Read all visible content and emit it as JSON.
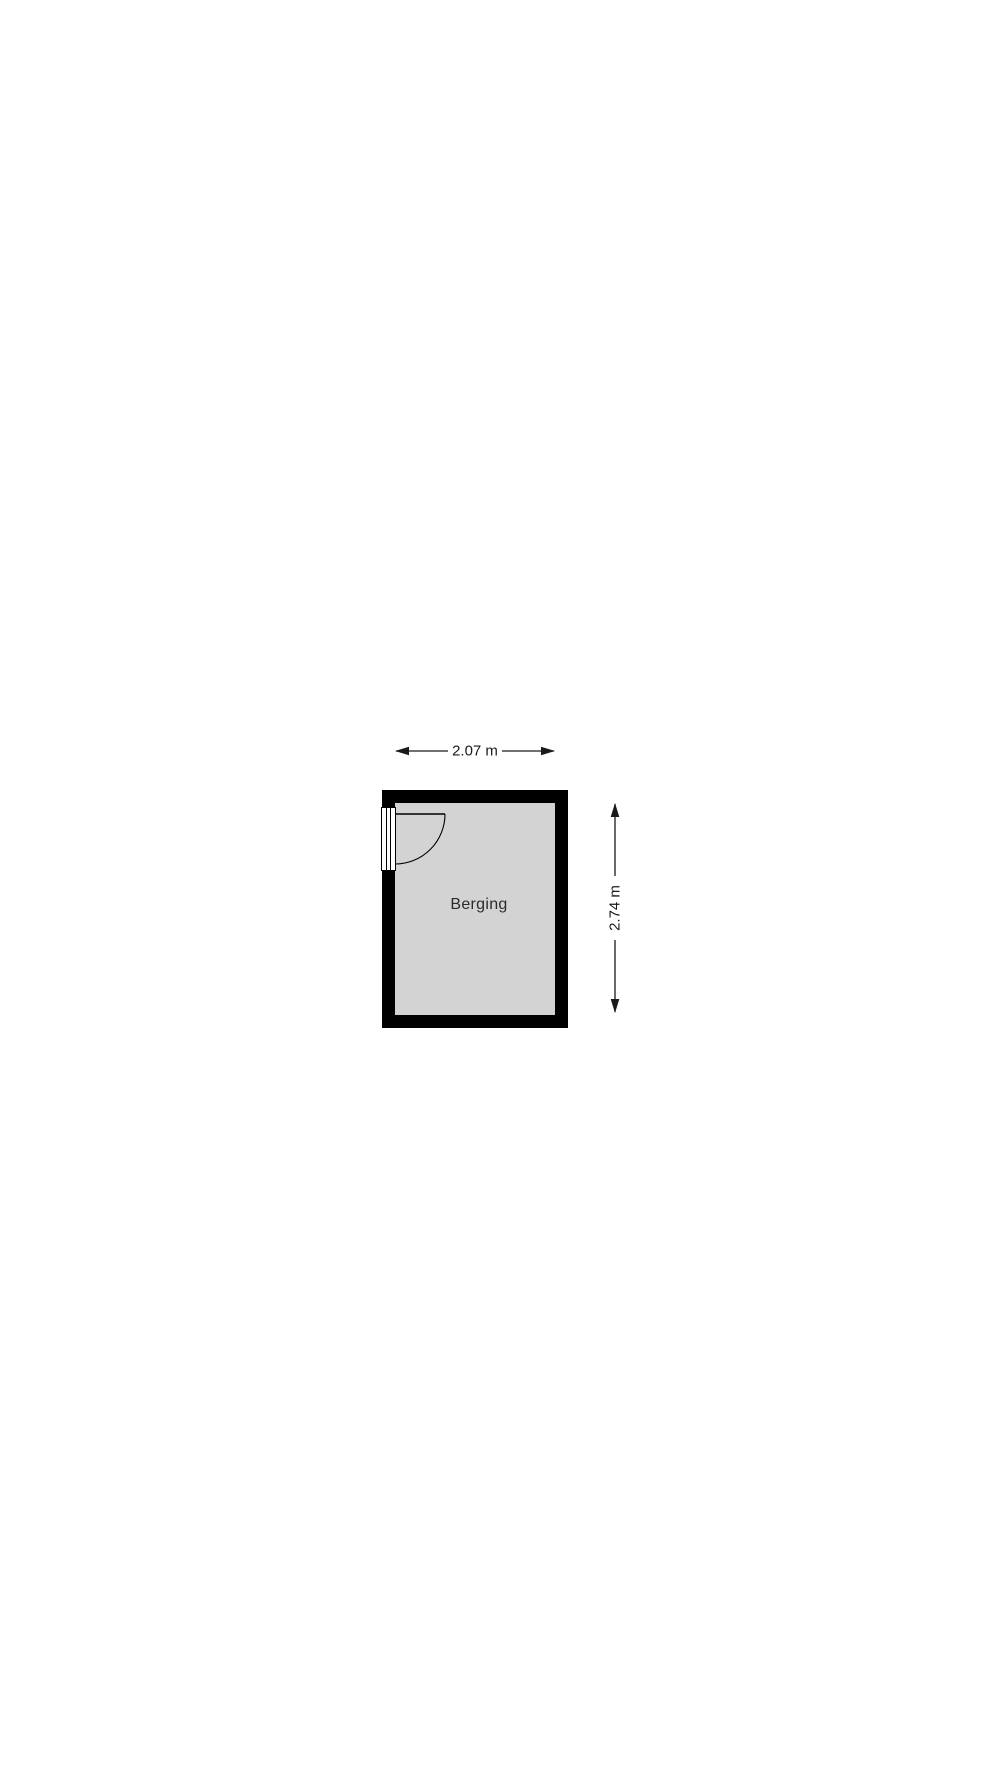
{
  "floorplan": {
    "room": {
      "name": "Berging"
    },
    "dimensions": {
      "width": "2.07 m",
      "height": "2.74 m"
    },
    "colors": {
      "wall": "#000000",
      "floor": "#d3d3d3",
      "background": "#ffffff",
      "annotation": "#1a1a1a"
    }
  }
}
